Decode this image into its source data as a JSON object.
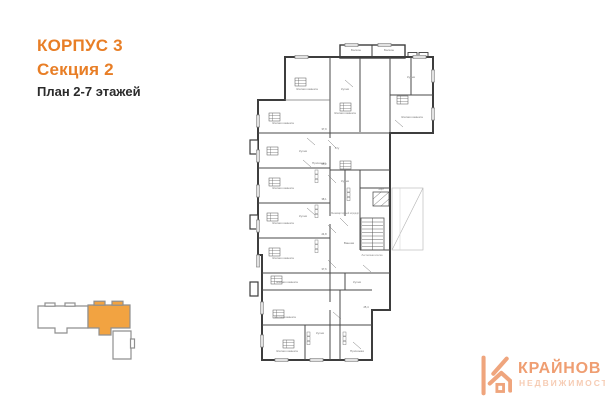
{
  "header": {
    "building": "КОРПУС 3",
    "section": "Секция 2",
    "floors": "План 2-7 этажей"
  },
  "colors": {
    "accent_orange": "#E87E26",
    "minimap_highlight": "#F2A341",
    "minimap_outline": "#8f8f8f",
    "plan_wall": "#3d3d3d",
    "logo_orange": "#EF9E72",
    "logo_light": "#F6CCB4"
  },
  "floor_plan": {
    "room_labels": [
      "Балкон",
      "Балкон",
      "Жилая комната",
      "Кухня",
      "Кухня",
      "Жилая комната",
      "Жилая комната",
      "Кухня",
      "Прихожая",
      "Жилая комната",
      "Кухня",
      "Жилая комната",
      "Жилая комната",
      "Межквартирный коридор",
      "Лестничная клетка",
      "Лифт",
      "Жилая комната",
      "Кухня",
      "С/у",
      "Жилая комната",
      "Кухня",
      "Жилая комната",
      "Жилая комната",
      "Прихожая",
      "Ванная",
      "Кухня"
    ],
    "area_marks": [
      "37,9",
      "25,2",
      "38,1",
      "24,8",
      "37,6",
      "25,4"
    ]
  },
  "logo": {
    "name": "КРАЙНОВ",
    "subtitle": "НЕДВИЖИМОСТЬ"
  }
}
